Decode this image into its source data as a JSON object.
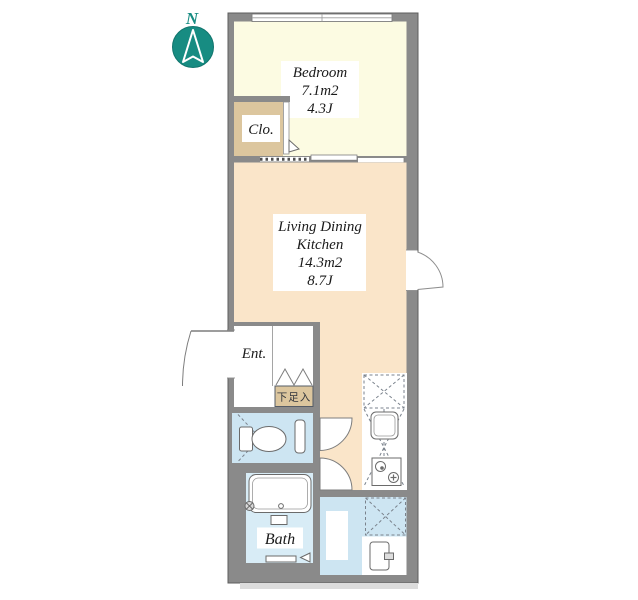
{
  "title": "apartment-floor-plan",
  "compass": {
    "label": "N"
  },
  "rooms": {
    "bedroom": {
      "name": "Bedroom",
      "area_m2": "7.1m2",
      "area_tatami": "4.3J"
    },
    "living": {
      "name_line1": "Living Dining",
      "name_line2": "Kitchen",
      "area_m2": "14.3m2",
      "area_tatami": "8.7J"
    },
    "closet": {
      "label": "Clo."
    },
    "entrance": {
      "label": "Ent."
    },
    "shoe_cabinet": {
      "label": "下足入"
    },
    "bath": {
      "label": "Bath"
    }
  },
  "colors": {
    "wall": "#8a8a8a",
    "bedroom_floor": "#fcfbe2",
    "living_floor": "#fae5c9",
    "closet_floor": "#dcc69e",
    "toilet_floor": "#cde5f2",
    "bath_floor": "#d8ecf6",
    "compass_teal": "#178c82"
  }
}
